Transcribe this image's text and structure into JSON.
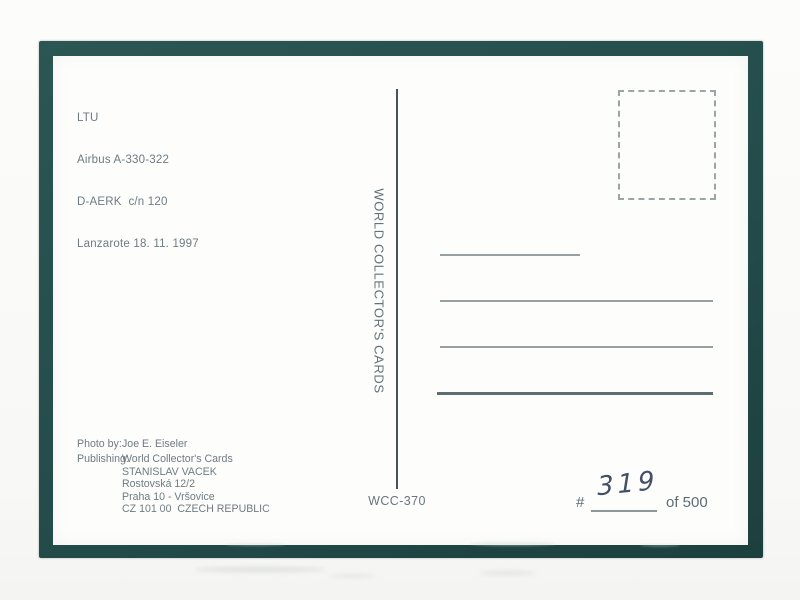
{
  "postcard": {
    "caption": {
      "lines": [
        "LTU",
        "Airbus A-330-322",
        "D-AERK  c/n 120",
        "Lanzarote 18. 11. 1997"
      ]
    },
    "spine_text": "WORLD COLLECTOR'S CARDS",
    "credits": {
      "rows": [
        {
          "label": "Photo by:",
          "value": "Joe E. Eiseler"
        },
        {
          "label": "Publishing:",
          "value": "World Collector's Cards"
        },
        {
          "label": "",
          "value": "STANISLAV VACEK"
        },
        {
          "label": "",
          "value": "Rostovská 12/2"
        },
        {
          "label": "",
          "value": "Praha 10 - Vršovice"
        },
        {
          "label": "",
          "value": "CZ 101 00  CZECH REPUBLIC"
        }
      ]
    },
    "catalog_number": "WCC-370",
    "edition": {
      "hash_symbol": "#",
      "handwritten_number": "319",
      "total_label": "of 500"
    },
    "address_ruled_lines": 4
  },
  "colors": {
    "frame_mat": "#234c4a",
    "card_surface": "#fdfdfb",
    "printed_ink": "#6e7c82",
    "divider_rule": "#41575a",
    "address_rule": "#97a1a3",
    "address_rule_bottom": "#5d6d70",
    "stamp_box_dash": "#9aa5a7",
    "handwriting_ink": "#3f5068"
  }
}
